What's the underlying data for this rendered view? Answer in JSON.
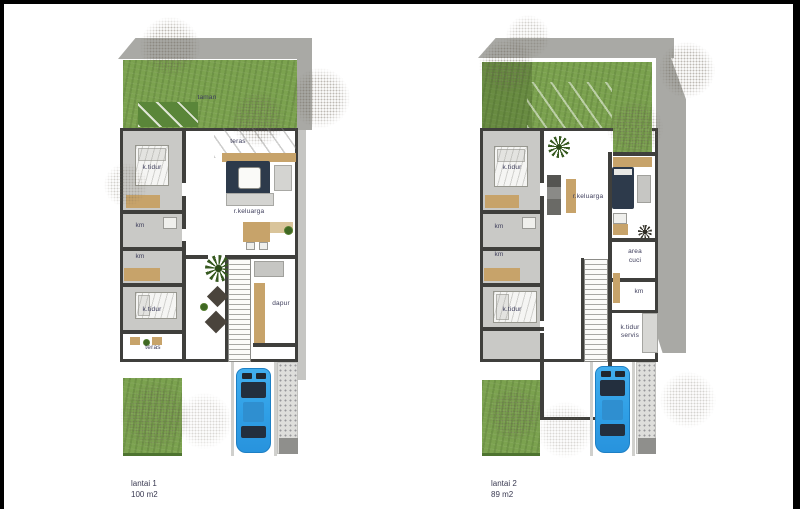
{
  "plan1": {
    "caption": {
      "line1": "lantai 1",
      "line2": "100 m2"
    },
    "labels": {
      "taman": "taman",
      "teras_atas": "teras",
      "ktidur_1": "k.tidur",
      "km_1": "km",
      "km_2": "km",
      "rkeluarga": "r.keluarga",
      "dapur": "dapur",
      "ktidur_2": "k.tidur",
      "teras_bawah": "teras"
    }
  },
  "plan2": {
    "caption": {
      "line1": "lantai 2",
      "line2": "89 m2"
    },
    "labels": {
      "ktidur_1": "k.tidur",
      "km_1": "km",
      "km_2": "km",
      "rkeluarga": "r.keluarga",
      "area_cuci_line1": "area",
      "area_cuci_line2": "cuci",
      "km_3": "km",
      "ktidur_2": "k.tidur",
      "ktidur_servis_line1": "k.tidur",
      "ktidur_servis_line2": "servis"
    }
  },
  "colors": {
    "frame-black": "#000000",
    "wall": "#3f3f3c",
    "floor-gray": "#c9c9c6",
    "roof-gray": "#a9a9a5",
    "garden-green": "#7ba24f",
    "garden-dark": "#5a8639",
    "wood": "#c7a36a",
    "navy": "#2d3a4b",
    "car-blue": "#2f9fe6",
    "label": "#3c3c5a"
  }
}
